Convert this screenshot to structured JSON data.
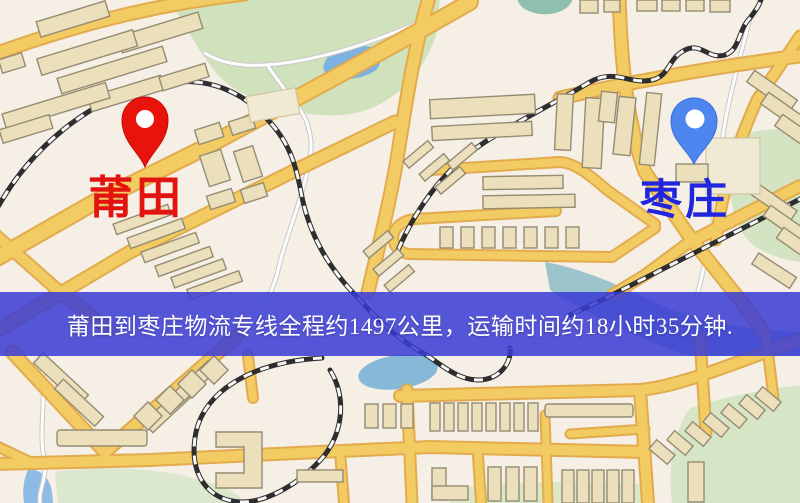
{
  "map": {
    "origin_marker": {
      "label": "莆田",
      "pin_color": "#e8140b",
      "pin_edge_color": "#c00d06",
      "label_color": "#e31410"
    },
    "destination_marker": {
      "label": "枣庄",
      "pin_color": "#4e86f0",
      "pin_edge_color": "#3a6fd8",
      "label_color": "#2026dd"
    },
    "banner": {
      "text": "莆田到枣庄物流专线全程约1497公里，运输时间约18小时35分钟.",
      "background": "#383bd3",
      "text_color": "#ffffff"
    },
    "route_summary": {
      "origin": "莆田",
      "destination": "枣庄",
      "distance_km": 1497,
      "duration_text": "18小时35分钟"
    },
    "legend_colors": {
      "map_background": "#f5efe6",
      "park": "#cfe2bb",
      "water": "#7cb2e2",
      "road": "#f3cb63",
      "building": "#ebdfbc",
      "railway": "#2e2e2e"
    }
  }
}
